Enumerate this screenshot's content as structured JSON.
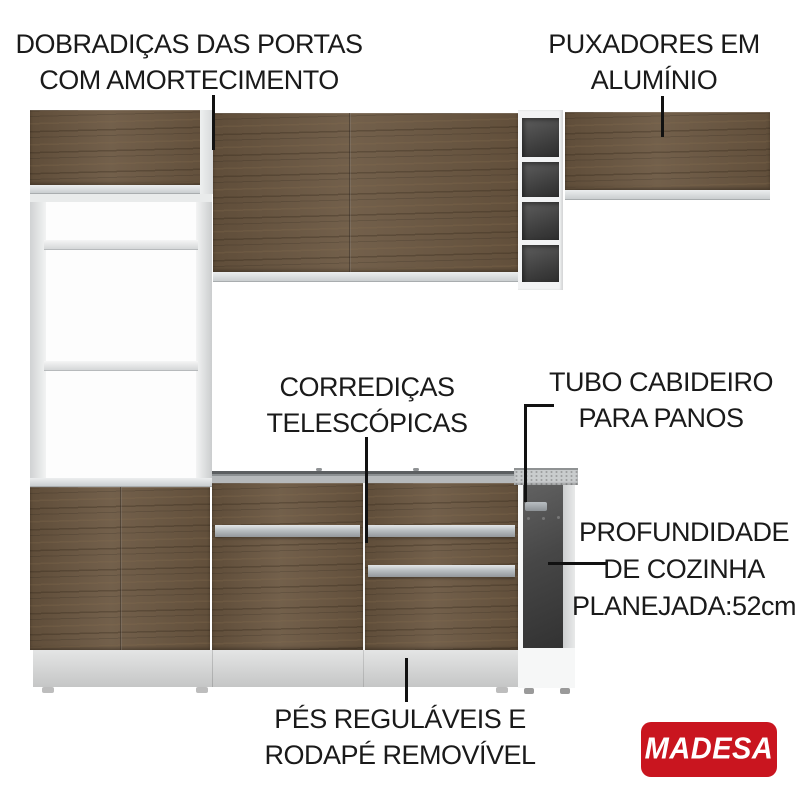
{
  "labels": {
    "hinges": {
      "line1": "DOBRADIÇAS DAS PORTAS",
      "line2": "COM AMORTECIMENTO"
    },
    "handles": {
      "line1": "PUXADORES EM",
      "line2": "ALUMÍNIO"
    },
    "slides": {
      "line1": "CORREDIÇAS",
      "line2": "TELESCÓPICAS"
    },
    "tube": {
      "line1": "TUBO CABIDEIRO",
      "line2": "PARA PANOS"
    },
    "depth": {
      "line1": "PROFUNDIDADE",
      "line2": "DE COZINHA",
      "line3": "PLANEJADA:52cm"
    },
    "feet": {
      "line1": "PÉS REGULÁVEIS E",
      "line2": "RODAPÉ REMOVÍVEL"
    }
  },
  "brand": {
    "name": "MADESA",
    "background": "#c9151f",
    "text_color": "#ffffff"
  },
  "colors": {
    "wood": "#6a5640",
    "frame_gray": "#ccd0d2",
    "niche_dark": "#3f3f3f",
    "callout": "#111111",
    "background": "#ffffff"
  }
}
